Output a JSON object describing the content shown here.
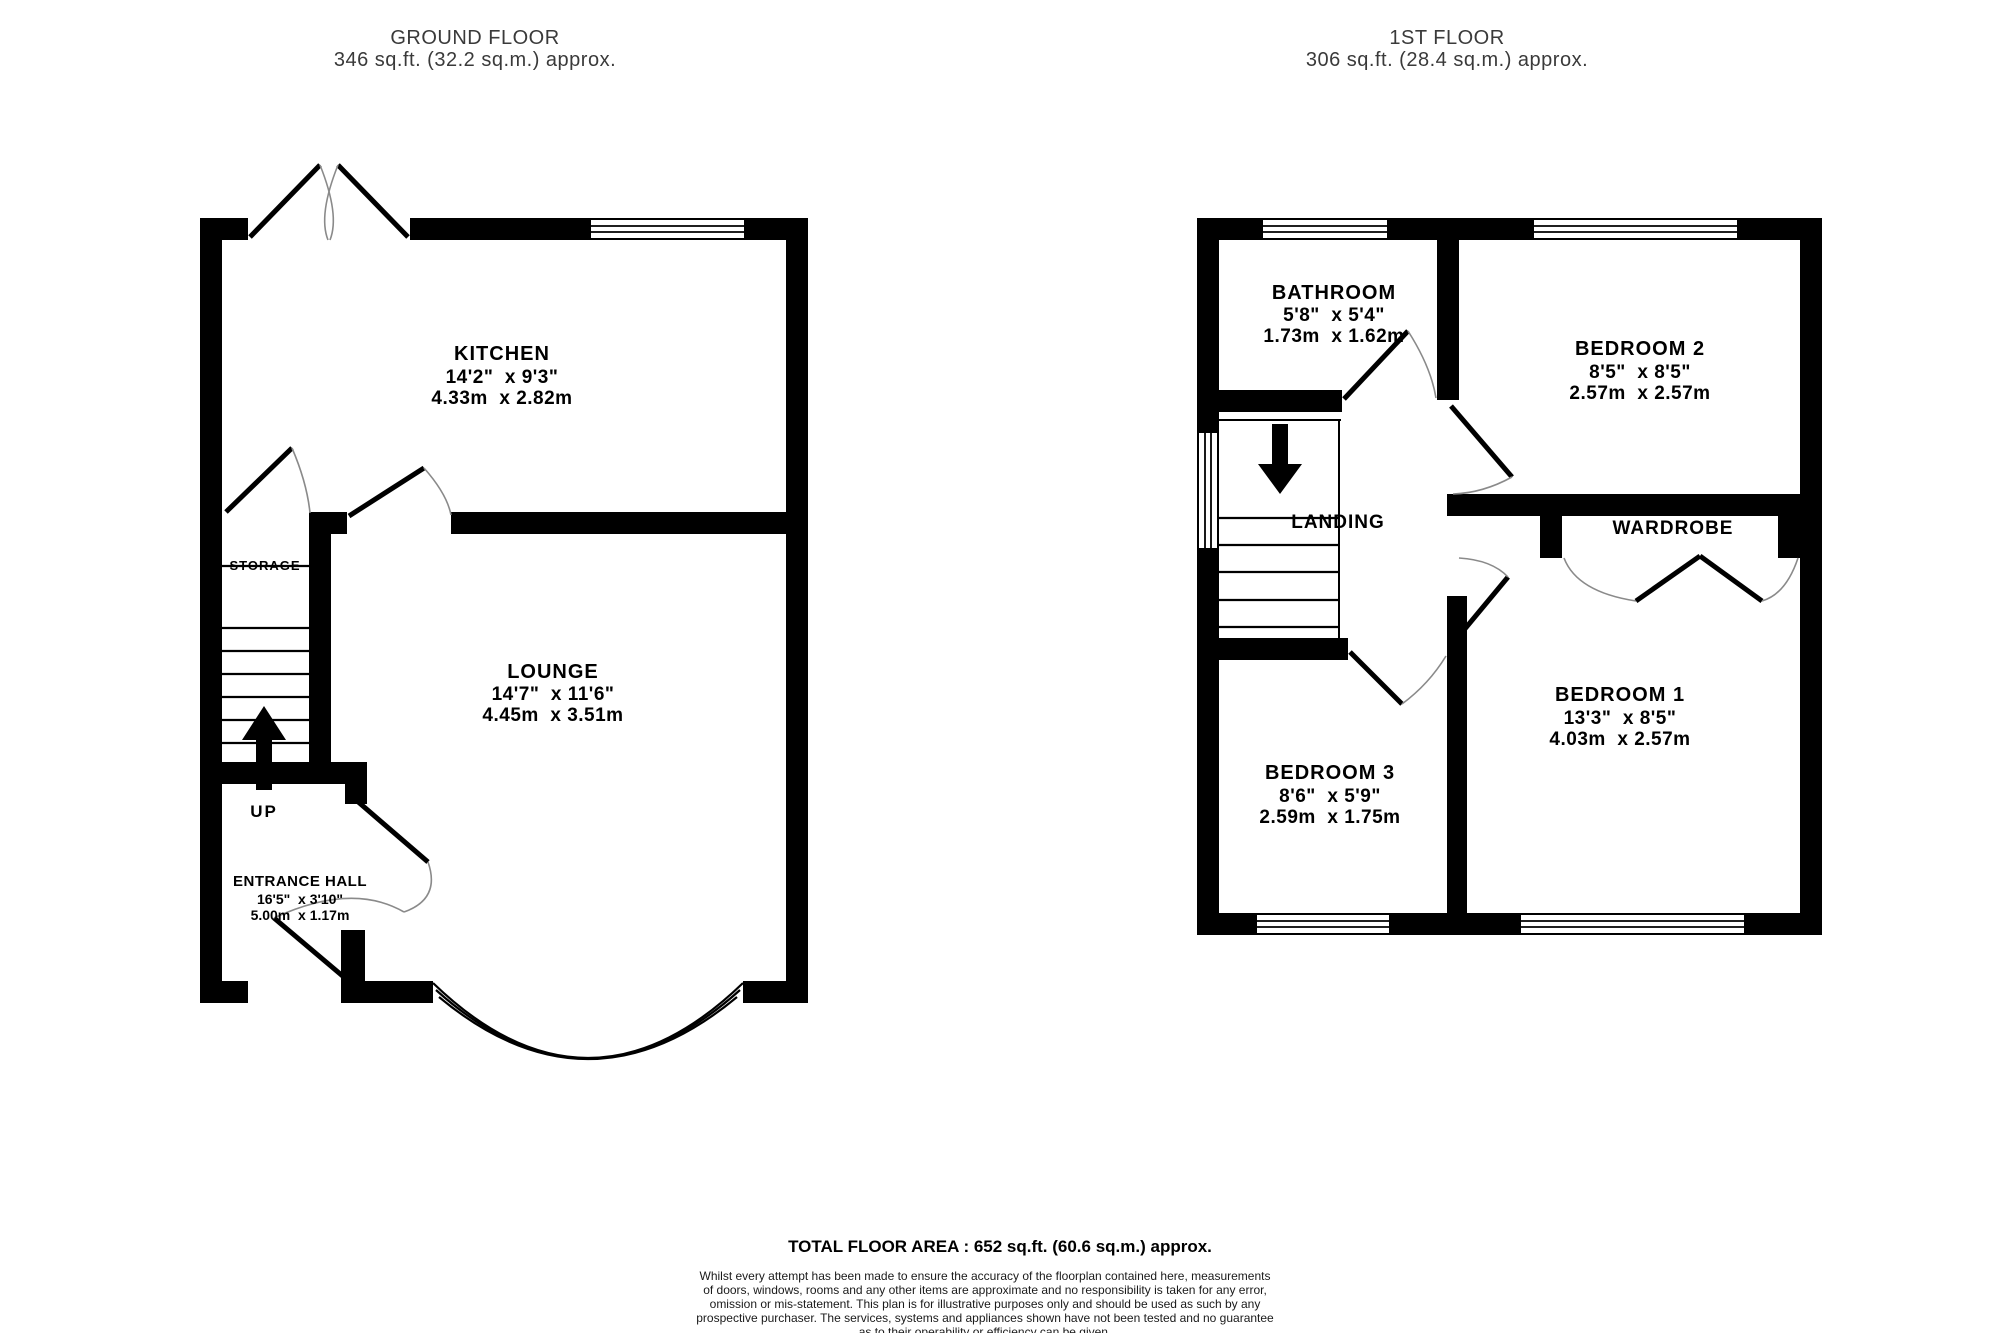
{
  "ground_floor": {
    "title": "GROUND FLOOR",
    "area": "346 sq.ft. (32.2 sq.m.) approx.",
    "rooms": {
      "kitchen": {
        "name": "KITCHEN",
        "imperial": "14'2\"  x 9'3\"",
        "metric": "4.33m  x 2.82m"
      },
      "lounge": {
        "name": "LOUNGE",
        "imperial": "14'7\"  x 11'6\"",
        "metric": "4.45m  x 3.51m"
      },
      "entrance_hall": {
        "name": "ENTRANCE HALL",
        "imperial": "16'5\"  x 3'10\"",
        "metric": "5.00m  x 1.17m"
      },
      "storage": {
        "name": "STORAGE"
      }
    },
    "stairs_direction_label": "UP"
  },
  "first_floor": {
    "title": "1ST FLOOR",
    "area": "306 sq.ft. (28.4 sq.m.) approx.",
    "rooms": {
      "bathroom": {
        "name": "BATHROOM",
        "imperial": "5'8\"  x 5'4\"",
        "metric": "1.73m  x 1.62m"
      },
      "bedroom2": {
        "name": "BEDROOM 2",
        "imperial": "8'5\"  x 8'5\"",
        "metric": "2.57m  x 2.57m"
      },
      "landing": {
        "name": "LANDING"
      },
      "wardrobe": {
        "name": "WARDROBE"
      },
      "bedroom1": {
        "name": "BEDROOM 1",
        "imperial": "13'3\"  x 8'5\"",
        "metric": "4.03m  x 2.57m"
      },
      "bedroom3": {
        "name": "BEDROOM 3",
        "imperial": "8'6\"  x 5'9\"",
        "metric": "2.59m  x 1.75m"
      }
    }
  },
  "footer": {
    "total_area": "TOTAL FLOOR AREA : 652 sq.ft. (60.6 sq.m.) approx.",
    "disclaimer_lines": [
      "Whilst every attempt has been made to ensure the accuracy of the floorplan contained here, measurements",
      "of doors, windows, rooms and any other items are approximate and no responsibility is taken for any error,",
      "omission or mis-statement. This plan is for illustrative purposes only and should be used as such by any",
      "prospective purchaser. The services, systems and appliances shown have not been tested and no guarantee",
      "as to their operability or efficiency can be given."
    ],
    "credit": "Made with Metropix ©2026"
  },
  "colors": {
    "wall": "#000000",
    "label": "#000000",
    "header": "#3a3a3a",
    "background": "#ffffff"
  }
}
